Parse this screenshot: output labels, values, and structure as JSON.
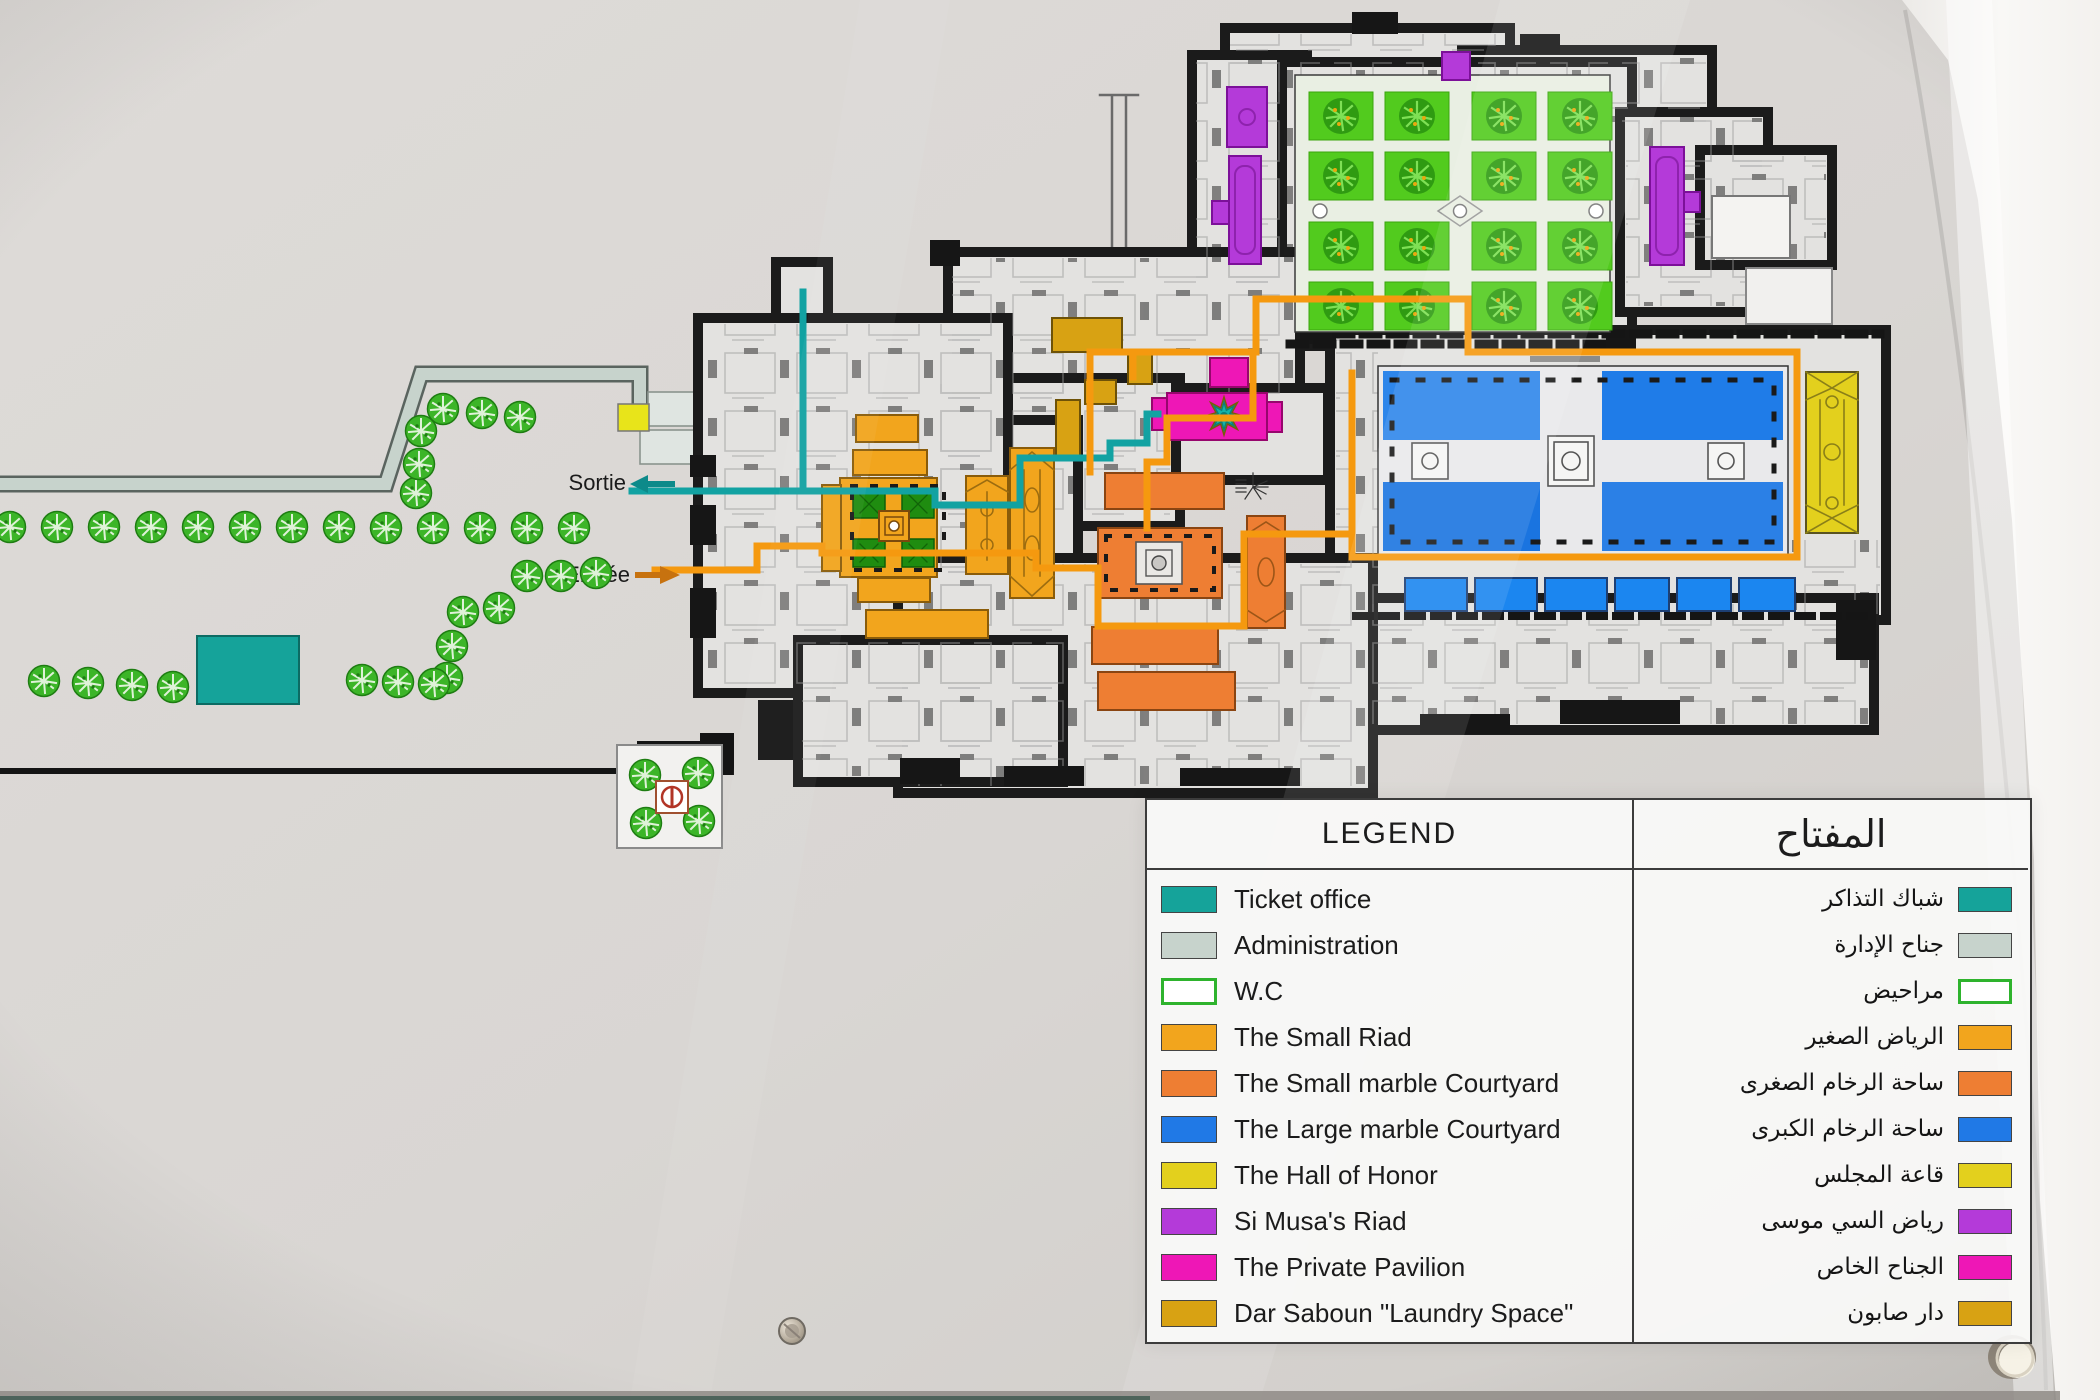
{
  "map": {
    "exit_label": "Sortie",
    "entrance_label": "Entrée",
    "colors": {
      "ticket_office": "#15a39a",
      "administration": "#c7d3cc",
      "wc_border": "#2eb32d",
      "small_riad": "#f2a51d",
      "small_marble_courtyard": "#ee7e33",
      "large_marble_courtyard": "#2079e6",
      "hall_of_honor": "#e3d01d",
      "si_musa_riad": "#b43ad9",
      "private_pavilion": "#ee17b6",
      "dar_saboun": "#d8a213",
      "garden_green": "#52cb1e",
      "exit_route": "#12a2a2",
      "entrance_route": "#f5990f"
    }
  },
  "legend": {
    "title_en": "LEGEND",
    "title_ar": "المفتاح",
    "rows": [
      {
        "en": "Ticket office",
        "ar": "شباك التذاكر",
        "color": "#15a39a"
      },
      {
        "en": "Administration",
        "ar": "جناح الإدارة",
        "color": "#c7d3cc"
      },
      {
        "en": "W.C",
        "ar": "مراحيض",
        "color": "#ffffff",
        "border": "#2eb32d"
      },
      {
        "en": "The Small Riad",
        "ar": "الرياض الصغير",
        "color": "#f2a51d"
      },
      {
        "en": "The Small marble Courtyard",
        "ar": "ساحة الرخام الصغرى",
        "color": "#ee7e33"
      },
      {
        "en": "The Large marble Courtyard",
        "ar": "ساحة الرخام الكبرى",
        "color": "#2079e6"
      },
      {
        "en": "The Hall of Honor",
        "ar": "قاعة المجلس",
        "color": "#e3d01d"
      },
      {
        "en": "Si Musa's Riad",
        "ar": "رياض السي موسى",
        "color": "#b43ad9"
      },
      {
        "en": "The Private Pavilion",
        "ar": "الجناح الخاص",
        "color": "#ee17b6"
      },
      {
        "en": "Dar Saboun \"Laundry Space\"",
        "ar": "دار صابون",
        "color": "#d8a213"
      }
    ]
  }
}
